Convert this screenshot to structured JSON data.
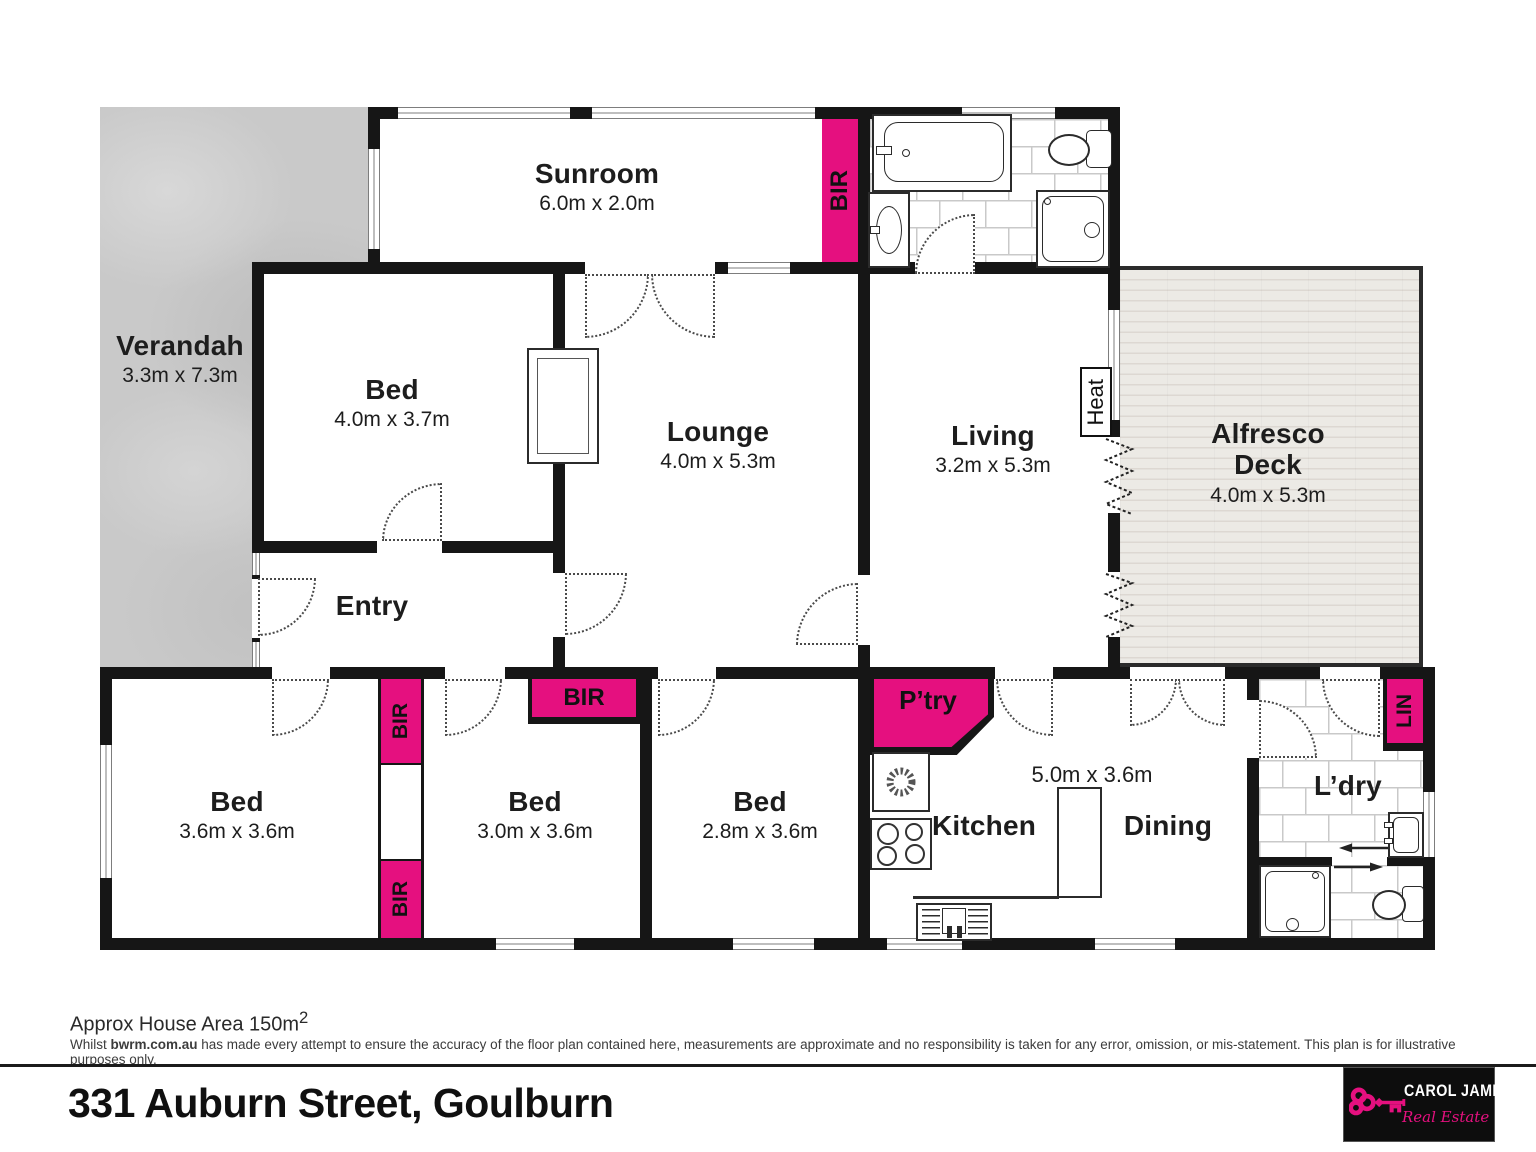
{
  "colors": {
    "accent": "#E5107F",
    "wall": "#161616"
  },
  "rooms": {
    "verandah": {
      "name": "Verandah",
      "dims": "3.3m x 7.3m"
    },
    "sunroom": {
      "name": "Sunroom",
      "dims": "6.0m x 2.0m"
    },
    "bed1": {
      "name": "Bed",
      "dims": "4.0m x 3.7m"
    },
    "lounge": {
      "name": "Lounge",
      "dims": "4.0m x 5.3m"
    },
    "living": {
      "name": "Living",
      "dims": "3.2m x 5.3m"
    },
    "alfresco": {
      "name": "Alfresco Deck",
      "dims": "4.0m x 5.3m"
    },
    "entry": {
      "name": "Entry"
    },
    "bed2": {
      "name": "Bed",
      "dims": "3.6m x 3.6m"
    },
    "bed3": {
      "name": "Bed",
      "dims": "3.0m x 3.6m"
    },
    "bed4": {
      "name": "Bed",
      "dims": "2.8m x 3.6m"
    },
    "kitchen": {
      "name": "Kitchen"
    },
    "dining": {
      "name": "Dining"
    },
    "kitchen_dining": {
      "dims": "5.0m x 3.6m"
    },
    "laundry": {
      "name": "L’dry"
    }
  },
  "markers": {
    "bir": "BIR",
    "pantry": "P’try",
    "linen": "LIN",
    "heater": "Heat"
  },
  "footer": {
    "area_label": "Approx House Area 150m",
    "area_superscript": "2",
    "disclaimer_prefix": "Whilst ",
    "disclaimer_brand": "bwrm.com.au",
    "disclaimer_rest": " has made every attempt to ensure the accuracy of the floor plan contained here, measurements are approximate and no responsibility is taken for any error, omission, or mis-statement. This plan is for illustrative purposes only.",
    "address": "331 Auburn Street, Goulburn"
  },
  "logo": {
    "name": "CAROL JAMES",
    "tagline": "Real Estate"
  }
}
